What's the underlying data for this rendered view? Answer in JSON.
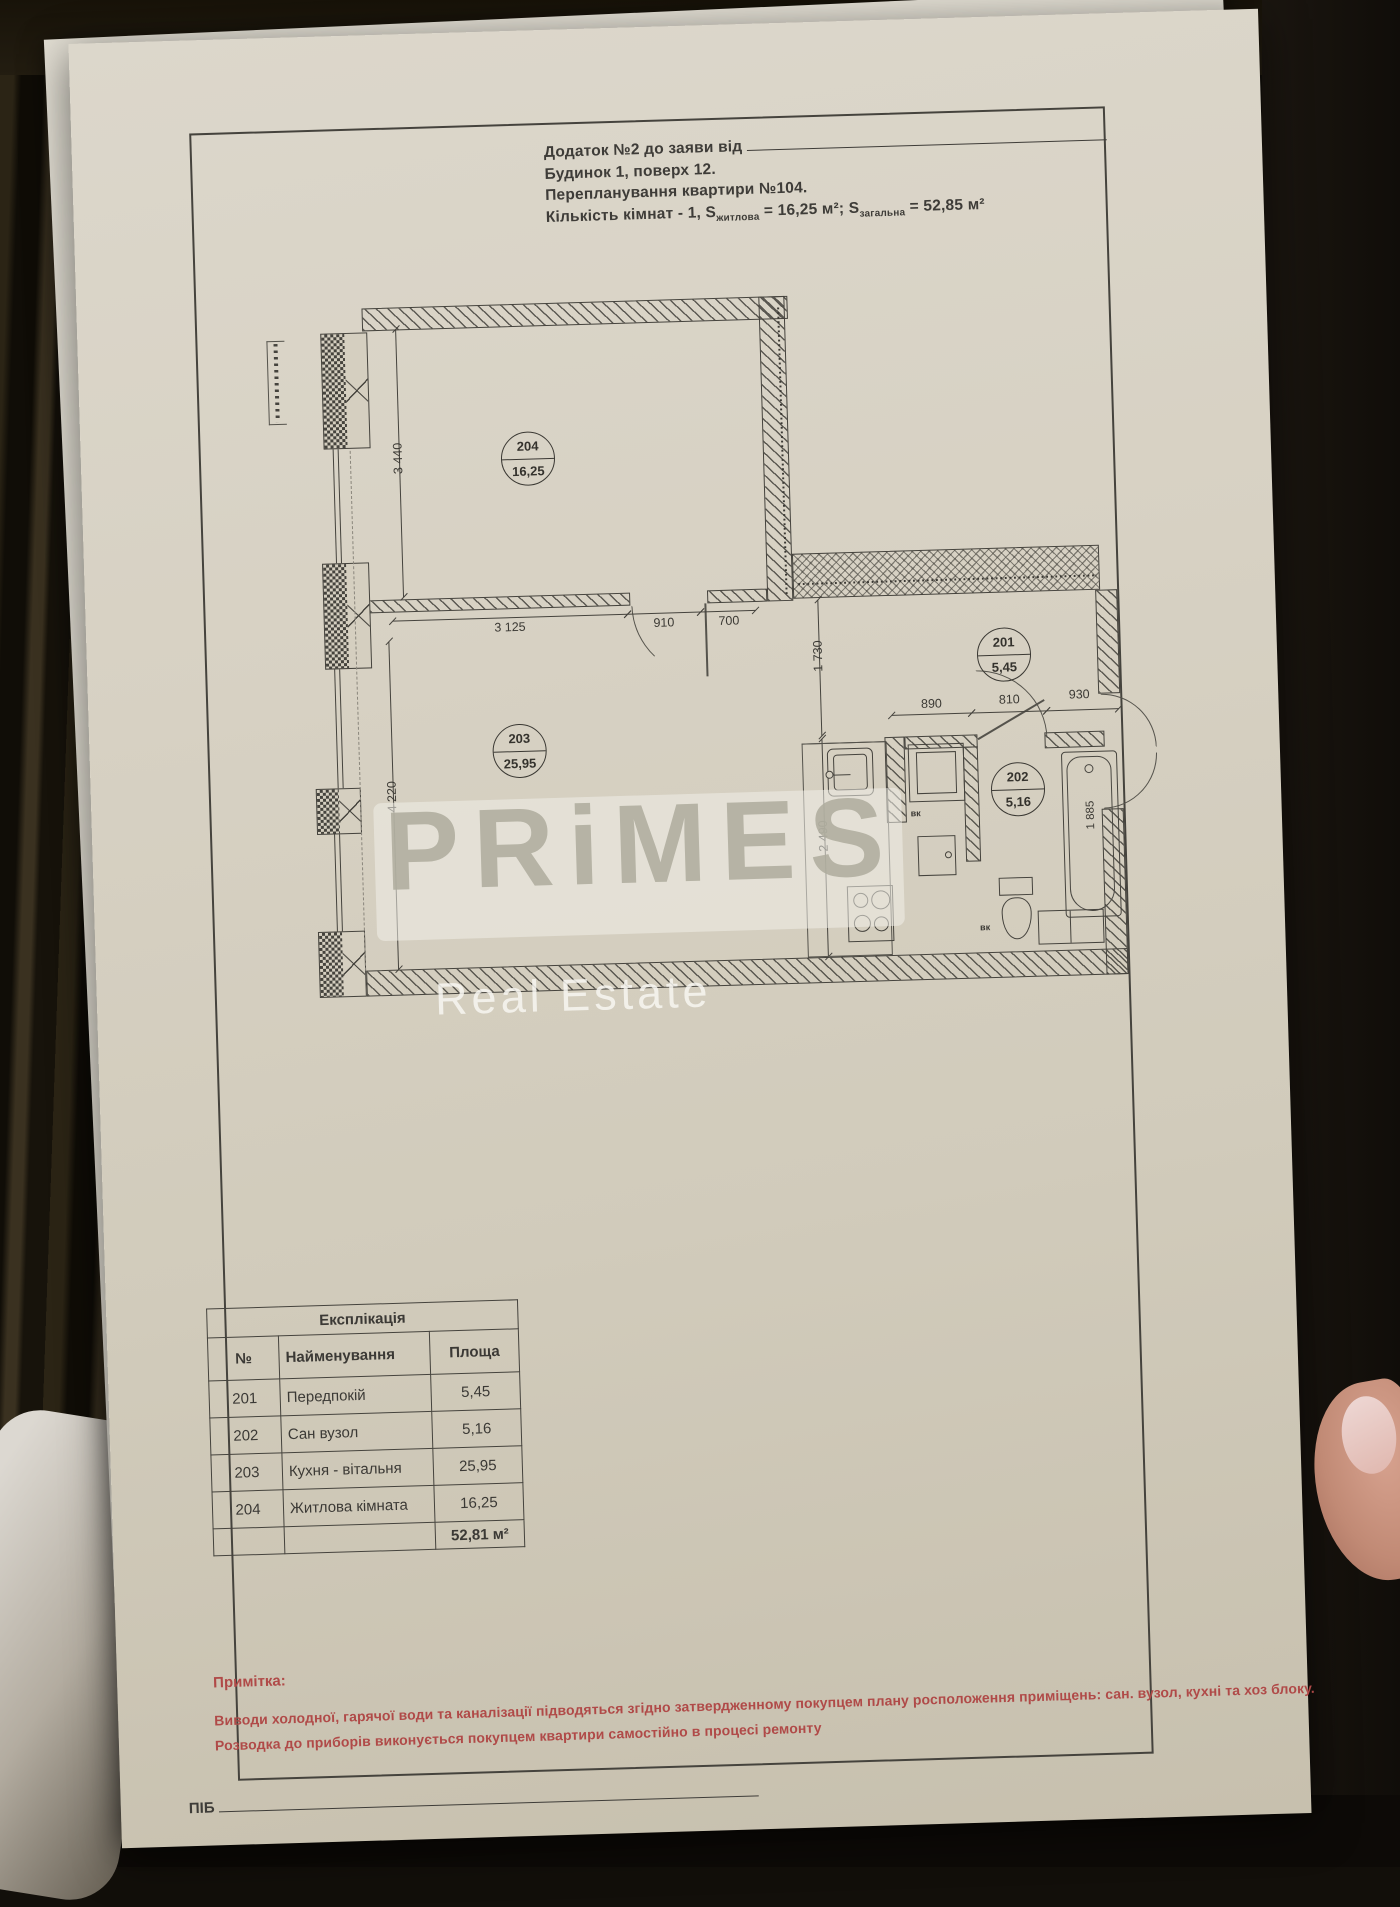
{
  "document": {
    "header": {
      "line1_label": "Додаток №2 до заяви від",
      "line2": "Будинок 1, поверх 12.",
      "line3": "Перепланування квартири №104.",
      "line4_prefix": "Кількість кімнат - 1, S",
      "line4_sub1": "житлова",
      "line4_mid": " = 16,25 м²; S",
      "line4_sub2": "загальна",
      "line4_suffix": " = 52,85 м²"
    },
    "plan": {
      "rooms": [
        {
          "number": "204",
          "area": "16,25"
        },
        {
          "number": "203",
          "area": "25,95"
        },
        {
          "number": "201",
          "area": "5,45"
        },
        {
          "number": "202",
          "area": "5,16"
        }
      ],
      "dims": {
        "w3440": "3 440",
        "w4220": "4 220",
        "w3125": "3 125",
        "w910": "910",
        "w700": "700",
        "h1730": "1 730",
        "w890": "890",
        "w810": "810",
        "w930": "930",
        "h2490": "2 490",
        "h1885": "1 885"
      },
      "labels": {
        "vk": "вк"
      }
    },
    "watermark": {
      "brand": "PRiMES",
      "subtitle": "Real Estate"
    },
    "table": {
      "title": "Експлікація",
      "col_no": "№",
      "col_name": "Найменування",
      "col_area": "Площа",
      "rows": [
        {
          "no": "201",
          "name": "Передпокій",
          "area": "5,45"
        },
        {
          "no": "202",
          "name": "Сан вузол",
          "area": "5,16"
        },
        {
          "no": "203",
          "name": "Кухня - вітальня",
          "area": "25,95"
        },
        {
          "no": "204",
          "name": "Житлова кімната",
          "area": "16,25"
        }
      ],
      "total": "52,81 м²"
    },
    "note": {
      "title": "Примітка:",
      "line1": "Виводи холодної, гарячої води та каналізації підводяться згідно затвердженному покупцем плану росположення приміщень: сан. вузол, кухні та хоз блоку.",
      "line2": "Розводка до приборів виконується покупцем квартири самостійно в процесі ремонту"
    },
    "footer": {
      "label": "ПІБ"
    }
  }
}
